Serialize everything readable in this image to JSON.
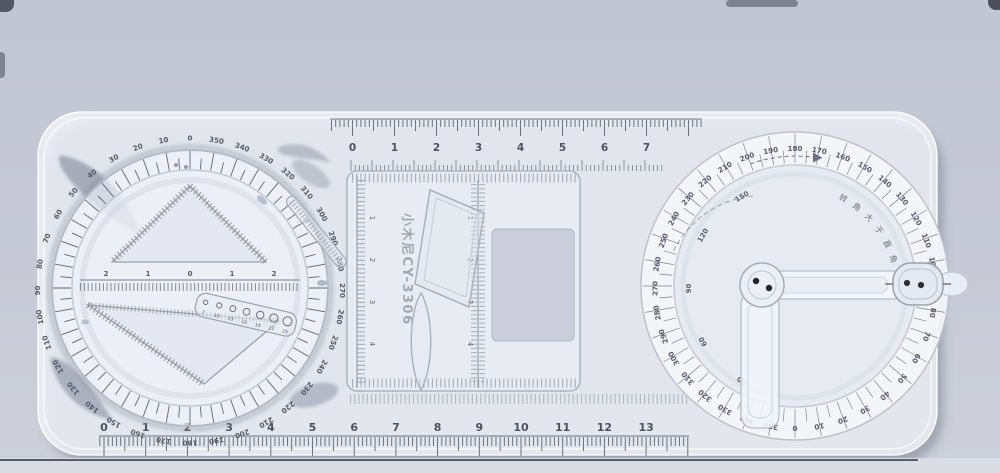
{
  "scene": {
    "description": "photograph of a multifunctional geometric drawing ruler template on a gray-blue surface",
    "background": "#c7cad6",
    "bottom_band": "#dadce4",
    "table_edge_color": "#43464f"
  },
  "brand_text": "小木尼CY-3306",
  "top_ruler": {
    "numbers": [
      "0",
      "1",
      "2",
      "3",
      "4",
      "5",
      "6",
      "7"
    ]
  },
  "bottom_ruler": {
    "numbers": [
      "0",
      "1",
      "2",
      "3",
      "4",
      "5",
      "6",
      "7",
      "8",
      "9",
      "10",
      "11",
      "12",
      "13"
    ]
  },
  "left_dial": {
    "degree_labels": [
      0,
      10,
      20,
      30,
      40,
      50,
      60,
      70,
      80,
      90,
      100,
      110,
      120,
      130,
      140,
      150,
      160,
      170,
      180,
      190,
      200,
      210,
      220,
      230,
      240,
      250,
      260,
      270,
      280,
      290,
      300,
      310,
      320,
      330,
      340,
      350
    ],
    "center_ruler_numbers": [
      "2",
      "1",
      "0",
      "1",
      "2"
    ],
    "circle_template_numbers": [
      "7",
      "10",
      "13",
      "16",
      "19",
      "22",
      "25"
    ]
  },
  "center_panel": {
    "left_ruler_numbers": [
      "1",
      "2",
      "3",
      "4"
    ],
    "mid_ruler_numbers": [
      "1",
      "2",
      "3",
      "4"
    ]
  },
  "right_protractor": {
    "outer_degree_labels": [
      0,
      10,
      20,
      30,
      40,
      50,
      60,
      70,
      80,
      90,
      100,
      110,
      120,
      130,
      140,
      150,
      160,
      170,
      180,
      190,
      200,
      210,
      220,
      230,
      240,
      250,
      260,
      270,
      280,
      290,
      300,
      310,
      320,
      330,
      340,
      350
    ],
    "inner_degree_labels": [
      30,
      60,
      90,
      120,
      150
    ],
    "arc_text": "转角大于直角"
  },
  "colors": {
    "ink": "#4d5263",
    "tick": "#5f6575",
    "stencil_stroke": "#a3a9b6",
    "body": "#f0f3f8",
    "cutout": "#c6cad6"
  }
}
